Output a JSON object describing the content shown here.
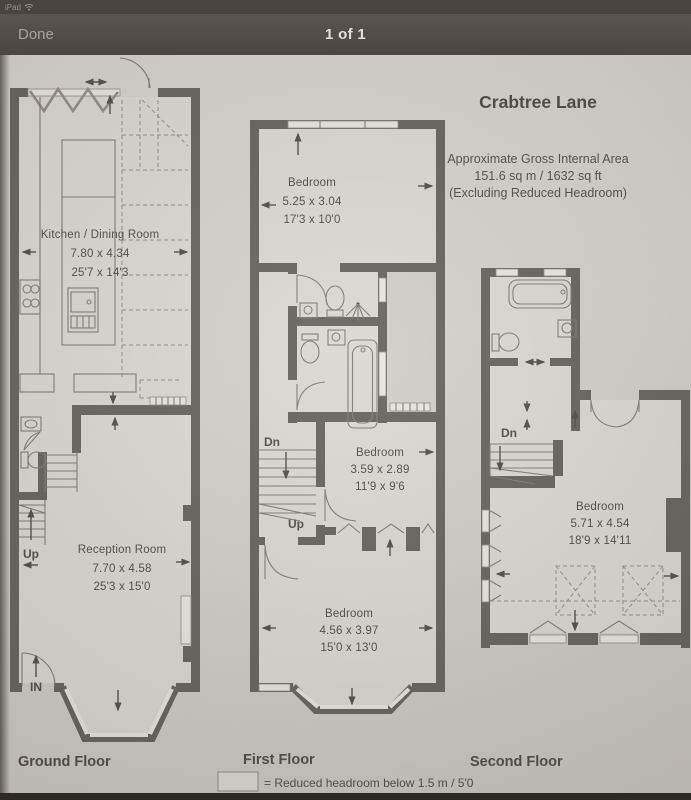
{
  "status_bar": {
    "device_label": "iPad"
  },
  "nav_bar": {
    "done_label": "Done",
    "page_indicator": "1 of 1"
  },
  "plan": {
    "title": "Crabtree Lane",
    "area": {
      "line1": "Approximate Gross Internal Area",
      "line2": "151.6 sq m / 1632 sq ft",
      "line3": "(Excluding Reduced Headroom)"
    },
    "ground": {
      "label": "Ground Floor",
      "kitchen": {
        "name": "Kitchen / Dining Room",
        "metric": "7.80 x 4.34",
        "imperial": "25'7 x 14'3"
      },
      "reception": {
        "name": "Reception Room",
        "metric": "7.70 x 4.58",
        "imperial": "25'3 x 15'0"
      },
      "up_label": "Up",
      "in_label": "IN"
    },
    "first": {
      "label": "First Floor",
      "bedroom_front": {
        "name": "Bedroom",
        "metric": "5.25 x 3.04",
        "imperial": "17'3 x 10'0"
      },
      "bedroom_middle": {
        "name": "Bedroom",
        "metric": "3.59 x 2.89",
        "imperial": "11'9 x 9'6"
      },
      "bedroom_back": {
        "name": "Bedroom",
        "metric": "4.56 x 3.97",
        "imperial": "15'0 x 13'0"
      },
      "dn_label": "Dn",
      "up_label": "Up"
    },
    "second": {
      "label": "Second Floor",
      "bedroom": {
        "name": "Bedroom",
        "metric": "5.71 x 4.54",
        "imperial": "18'9 x 14'11"
      },
      "dn_label": "Dn"
    },
    "legend": {
      "text": "= Reduced headroom below 1.5 m / 5'0"
    }
  },
  "colors": {
    "chrome_bar": "#524c46",
    "paper": "#d2cfc8",
    "wall": "#615d57",
    "ink": "#4a4640"
  }
}
